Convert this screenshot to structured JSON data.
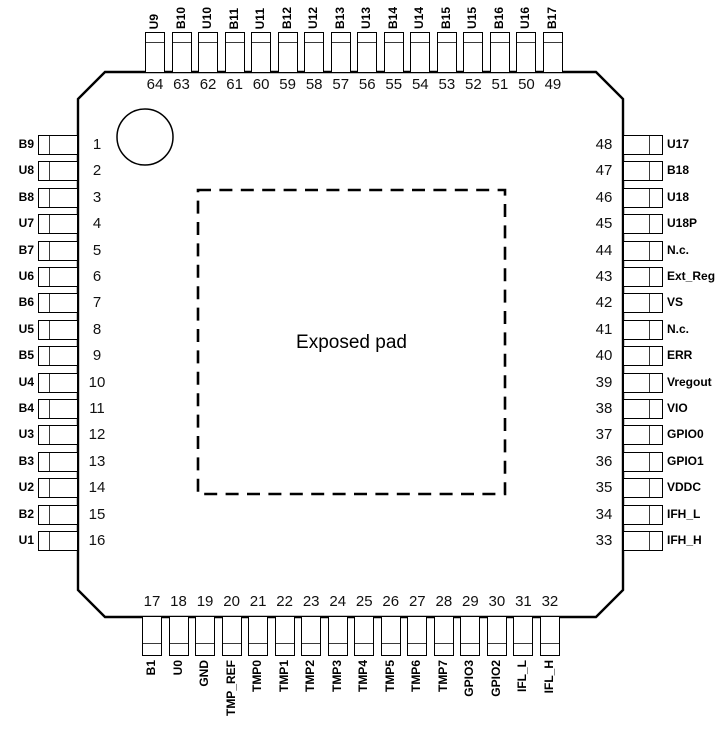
{
  "diagram": {
    "title": "64-pin QFP package pinout",
    "exposed_pad_label": "Exposed pad",
    "line_color": "#000000",
    "background_color": "#ffffff"
  },
  "pins": {
    "left": [
      {
        "number": "1",
        "name": "B9"
      },
      {
        "number": "2",
        "name": "U8"
      },
      {
        "number": "3",
        "name": "B8"
      },
      {
        "number": "4",
        "name": "U7"
      },
      {
        "number": "5",
        "name": "B7"
      },
      {
        "number": "6",
        "name": "U6"
      },
      {
        "number": "7",
        "name": "B6"
      },
      {
        "number": "8",
        "name": "U5"
      },
      {
        "number": "9",
        "name": "B5"
      },
      {
        "number": "10",
        "name": "U4"
      },
      {
        "number": "11",
        "name": "B4"
      },
      {
        "number": "12",
        "name": "U3"
      },
      {
        "number": "13",
        "name": "B3"
      },
      {
        "number": "14",
        "name": "U2"
      },
      {
        "number": "15",
        "name": "B2"
      },
      {
        "number": "16",
        "name": "U1"
      }
    ],
    "top": [
      {
        "number": "64",
        "name": "U9"
      },
      {
        "number": "63",
        "name": "B10"
      },
      {
        "number": "62",
        "name": "U10"
      },
      {
        "number": "61",
        "name": "B11"
      },
      {
        "number": "60",
        "name": "U11"
      },
      {
        "number": "59",
        "name": "B12"
      },
      {
        "number": "58",
        "name": "U12"
      },
      {
        "number": "57",
        "name": "B13"
      },
      {
        "number": "56",
        "name": "U13"
      },
      {
        "number": "55",
        "name": "B14"
      },
      {
        "number": "54",
        "name": "U14"
      },
      {
        "number": "53",
        "name": "B15"
      },
      {
        "number": "52",
        "name": "U15"
      },
      {
        "number": "51",
        "name": "B16"
      },
      {
        "number": "50",
        "name": "U16"
      },
      {
        "number": "49",
        "name": "B17"
      }
    ],
    "right": [
      {
        "number": "48",
        "name": "U17"
      },
      {
        "number": "47",
        "name": "B18"
      },
      {
        "number": "46",
        "name": "U18"
      },
      {
        "number": "45",
        "name": "U18P"
      },
      {
        "number": "44",
        "name": "N.c."
      },
      {
        "number": "43",
        "name": "Ext_Reg"
      },
      {
        "number": "42",
        "name": "VS"
      },
      {
        "number": "41",
        "name": "N.c."
      },
      {
        "number": "40",
        "name": "ERR"
      },
      {
        "number": "39",
        "name": "Vregout"
      },
      {
        "number": "38",
        "name": "VIO"
      },
      {
        "number": "37",
        "name": "GPIO0"
      },
      {
        "number": "36",
        "name": "GPIO1"
      },
      {
        "number": "35",
        "name": "VDDC"
      },
      {
        "number": "34",
        "name": "IFH_L"
      },
      {
        "number": "33",
        "name": "IFH_H"
      }
    ],
    "bottom": [
      {
        "number": "17",
        "name": "B1"
      },
      {
        "number": "18",
        "name": "U0"
      },
      {
        "number": "19",
        "name": "GND"
      },
      {
        "number": "20",
        "name": "TMP_REF"
      },
      {
        "number": "21",
        "name": "TMP0"
      },
      {
        "number": "22",
        "name": "TMP1"
      },
      {
        "number": "23",
        "name": "TMP2"
      },
      {
        "number": "24",
        "name": "TMP3"
      },
      {
        "number": "25",
        "name": "TMP4"
      },
      {
        "number": "26",
        "name": "TMP5"
      },
      {
        "number": "27",
        "name": "TMP6"
      },
      {
        "number": "28",
        "name": "TMP7"
      },
      {
        "number": "29",
        "name": "GPIO3"
      },
      {
        "number": "30",
        "name": "GPIO2"
      },
      {
        "number": "31",
        "name": "IFL_L"
      },
      {
        "number": "32",
        "name": "IFL_H"
      }
    ]
  }
}
